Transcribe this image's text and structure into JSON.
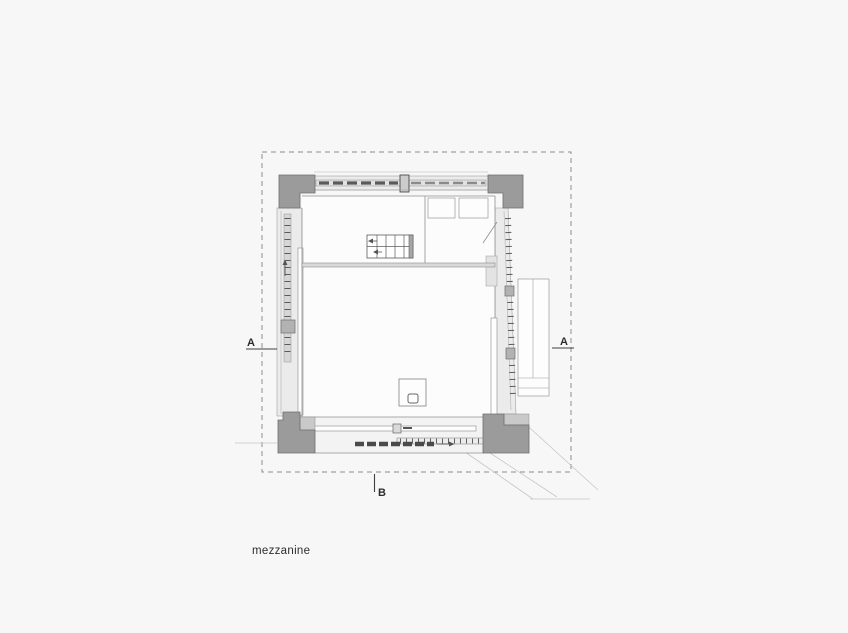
{
  "drawing": {
    "title": "mezzanine",
    "labels": {
      "section_a_left": "A",
      "section_a_right": "A",
      "section_b": "B"
    },
    "colors": {
      "background": "#f7f7f7",
      "boundary_dash": "#8e8e8e",
      "column_fill": "#9b9b9b",
      "column_stroke": "#6e6e6e",
      "wall_fill": "#ebebeb",
      "interior_fill": "#fcfcfc",
      "detail_dark": "#4a4a4a",
      "line_medium": "#8f8f8f",
      "site_line": "#c6c6c6",
      "text": "#2d2d2d"
    }
  }
}
